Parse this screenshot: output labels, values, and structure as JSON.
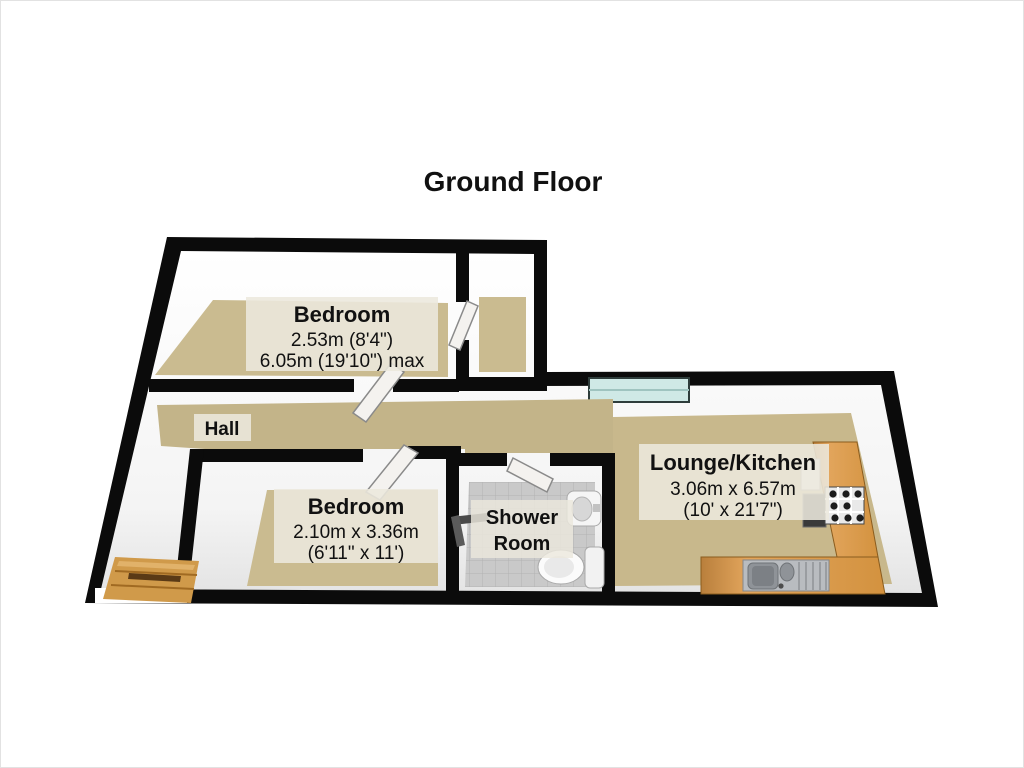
{
  "title": "Ground Floor",
  "colors": {
    "wall": "#0b0b0b",
    "carpet": "#cabb90",
    "hall_carpet": "#c3b489",
    "lounge_carpet": "#c8b88c",
    "tile": "#c9c9c9",
    "counter": "#dd9e56",
    "counter_edge": "#a8762f",
    "window": "#cfe9e6",
    "wood": "#d09a4a",
    "label_bg": "#ece8dd",
    "door": "#f4f2ef",
    "fixture_white": "#f5f5f5"
  },
  "rooms": {
    "bedroom_top": {
      "name": "Bedroom",
      "dim1": "2.53m (8'4\")",
      "dim2": "6.05m (19'10\") max"
    },
    "hall": {
      "name": "Hall"
    },
    "bedroom_bottom": {
      "name": "Bedroom",
      "dim1": "2.10m x 3.36m",
      "dim2": "(6'11\" x 11')"
    },
    "shower_room": {
      "name_line1": "Shower",
      "name_line2": "Room"
    },
    "lounge_kitchen": {
      "name": "Lounge/Kitchen",
      "dim1": "3.06m x 6.57m",
      "dim2": "(10' x 21'7\")"
    }
  }
}
